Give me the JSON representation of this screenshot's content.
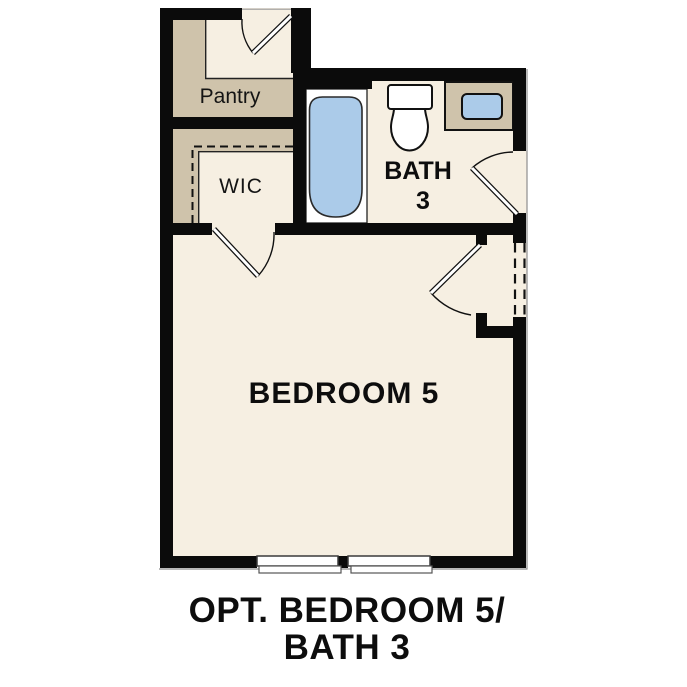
{
  "document": {
    "type": "floor-plan-option-diagram",
    "title": "OPT. BEDROOM 5/ BATH 3"
  },
  "caption": {
    "line1": "OPT. BEDROOM 5/",
    "line2": "BATH 3"
  },
  "rooms": {
    "pantry": {
      "label": "Pantry"
    },
    "wic": {
      "label": "WIC"
    },
    "bath": {
      "label_line1": "BATH",
      "label_line2": "3"
    },
    "bedroom": {
      "label": "BEDROOM 5"
    }
  },
  "fixtures": {
    "bathtub": "bathtub",
    "toilet": "toilet",
    "vanity": "vanity-counter",
    "sink": "sink-basin"
  },
  "features": {
    "doors": [
      "pantry-door",
      "wic-door",
      "bath-door",
      "bedroom-door"
    ],
    "optional_opening": "dashed-cased-opening",
    "windows": 2
  },
  "colors": {
    "background": "#ffffff",
    "wall": "#0b0b0b",
    "floor": "#f6efe2",
    "closet_tan": "#cfc3ab",
    "fixture_blue": "#abcbe9",
    "fixture_white": "#ffffff",
    "text": "#0d0d0d"
  }
}
